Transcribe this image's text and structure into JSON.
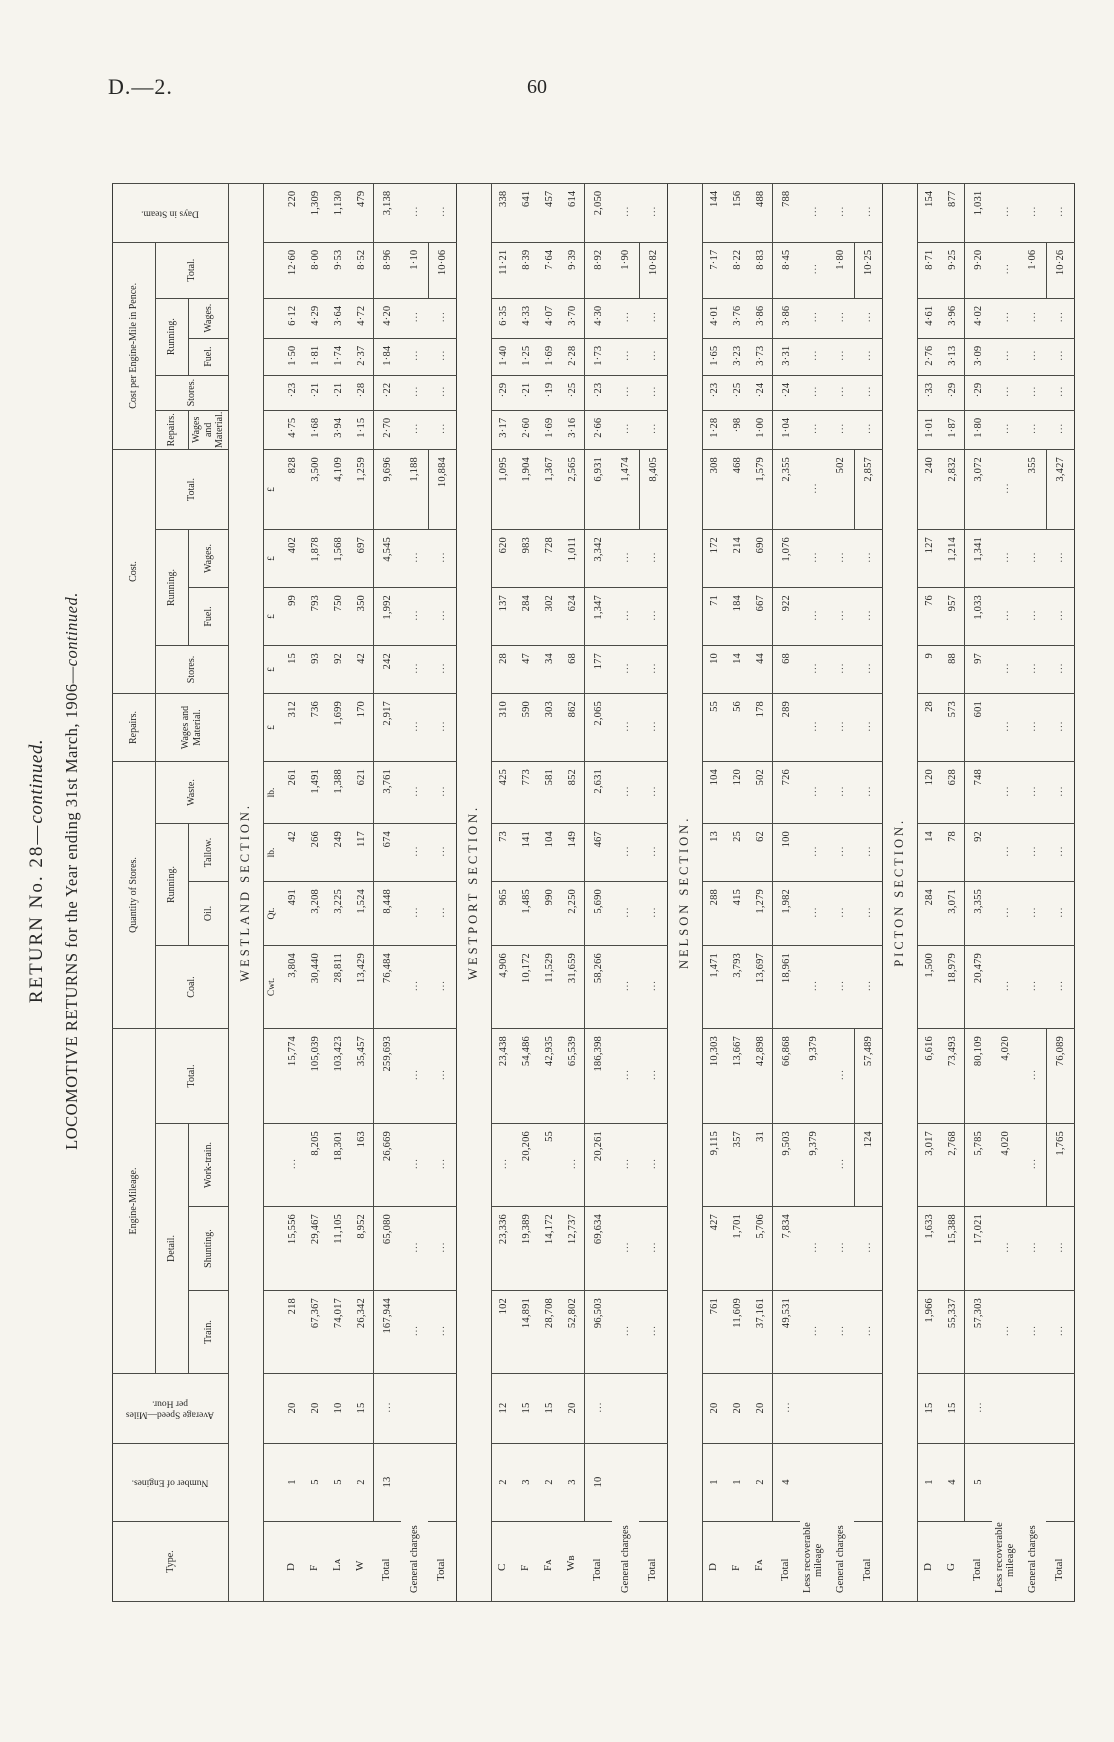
{
  "page": {
    "doc_ref": "D.—2.",
    "page_number": "60"
  },
  "title": {
    "line1": "RETURN No. 28—",
    "line1_cont": "continued.",
    "line2": "LOCOMOTIVE RETURNS for the Year ending 31st March, 1906—",
    "line2_cont": "continued."
  },
  "headers": {
    "type": "Type.",
    "number_of_engines": "Number of Engines.",
    "average_speed": "Average Speed—Miles per Hour.",
    "engine_mileage": "Engine-Mileage.",
    "detail": "Detail.",
    "train": "Train.",
    "shunting": "Shunting.",
    "work_train": "Work-train.",
    "total": "Total.",
    "quantity_of_stores": "Quantity of Stores.",
    "coal": "Coal.",
    "running": "Running.",
    "oil": "Oil.",
    "tallow": "Tallow.",
    "waste": "Waste.",
    "repairs": "Repairs.",
    "wages_and_material": "Wages and Material.",
    "cost": "Cost.",
    "stores": "Stores.",
    "fuel": "Fuel.",
    "wages": "Wages.",
    "cost_per_mile": "Cost per Engine-Mile in Pence.",
    "days_in_steam": "Days in Steam."
  },
  "units": [
    "",
    "",
    "",
    "",
    "",
    "",
    "Cwt.",
    "Qt.",
    "lb.",
    "lb.",
    "£",
    "£",
    "£",
    "£",
    "£",
    "",
    "",
    "",
    "",
    "",
    ""
  ],
  "sections": [
    {
      "name": "WESTLAND SECTION.",
      "show_units": true,
      "rows": [
        {
          "label": "D",
          "kind": "data",
          "cells": [
            "1",
            "20",
            "218",
            "15,556",
            "...",
            "15,774",
            "3,804",
            "491",
            "42",
            "261",
            "312",
            "15",
            "99",
            "402",
            "828",
            "4·75",
            "·23",
            "1·50",
            "6·12",
            "12·60",
            "220"
          ]
        },
        {
          "label": "F",
          "kind": "data",
          "cells": [
            "5",
            "20",
            "67,367",
            "29,467",
            "8,205",
            "105,039",
            "30,440",
            "3,208",
            "266",
            "1,491",
            "736",
            "93",
            "793",
            "1,878",
            "3,500",
            "1·68",
            "·21",
            "1·81",
            "4·29",
            "8·00",
            "1,309"
          ]
        },
        {
          "label": "Lᴀ",
          "kind": "data",
          "cells": [
            "5",
            "10",
            "74,017",
            "11,105",
            "18,301",
            "103,423",
            "28,811",
            "3,225",
            "249",
            "1,388",
            "1,699",
            "92",
            "750",
            "1,568",
            "4,109",
            "3·94",
            "·21",
            "1·74",
            "3·64",
            "9·53",
            "1,130"
          ]
        },
        {
          "label": "W",
          "kind": "data",
          "cells": [
            "2",
            "15",
            "26,342",
            "8,952",
            "163",
            "35,457",
            "13,429",
            "1,524",
            "117",
            "621",
            "170",
            "42",
            "350",
            "697",
            "1,259",
            "1·15",
            "·28",
            "2·37",
            "4·72",
            "8·52",
            "479"
          ]
        },
        {
          "label": "Total",
          "kind": "total",
          "cells": [
            "13",
            "...",
            "167,944",
            "65,080",
            "26,669",
            "259,693",
            "76,484",
            "8,448",
            "674",
            "3,761",
            "2,917",
            "242",
            "1,992",
            "4,545",
            "9,696",
            "2·70",
            "·22",
            "1·84",
            "4·20",
            "8·96",
            "3,138"
          ]
        },
        {
          "label": "General charges",
          "kind": "gen",
          "wide": true,
          "cells": [
            "",
            "",
            "...",
            "...",
            "...",
            "...",
            "...",
            "...",
            "...",
            "...",
            "...",
            "...",
            "...",
            "...",
            "1,188",
            "...",
            "...",
            "...",
            "...",
            "1·10",
            "..."
          ]
        },
        {
          "label": "Total",
          "kind": "final",
          "cells": [
            "",
            "",
            "...",
            "...",
            "...",
            "...",
            "...",
            "...",
            "...",
            "...",
            "...",
            "...",
            "...",
            "...",
            "10,884",
            "...",
            "...",
            "...",
            "...",
            "10·06",
            "..."
          ]
        }
      ]
    },
    {
      "name": "WESTPORT SECTION.",
      "show_units": false,
      "rows": [
        {
          "label": "C",
          "kind": "data",
          "cells": [
            "2",
            "12",
            "102",
            "23,336",
            "...",
            "23,438",
            "4,906",
            "965",
            "73",
            "425",
            "310",
            "28",
            "137",
            "620",
            "1,095",
            "3·17",
            "·29",
            "1·40",
            "6·35",
            "11·21",
            "338"
          ]
        },
        {
          "label": "F",
          "kind": "data",
          "cells": [
            "3",
            "15",
            "14,891",
            "19,389",
            "20,206",
            "54,486",
            "10,172",
            "1,485",
            "141",
            "773",
            "590",
            "47",
            "284",
            "983",
            "1,904",
            "2·60",
            "·21",
            "1·25",
            "4·33",
            "8·39",
            "641"
          ]
        },
        {
          "label": "Fᴀ",
          "kind": "data",
          "cells": [
            "2",
            "15",
            "28,708",
            "14,172",
            "55",
            "42,935",
            "11,529",
            "990",
            "104",
            "581",
            "303",
            "34",
            "302",
            "728",
            "1,367",
            "1·69",
            "·19",
            "1·69",
            "4·07",
            "7·64",
            "457"
          ]
        },
        {
          "label": "Wʙ",
          "kind": "data",
          "cells": [
            "3",
            "20",
            "52,802",
            "12,737",
            "...",
            "65,539",
            "31,659",
            "2,250",
            "149",
            "852",
            "862",
            "68",
            "624",
            "1,011",
            "2,565",
            "3·16",
            "·25",
            "2·28",
            "3·70",
            "9·39",
            "614"
          ]
        },
        {
          "label": "Total",
          "kind": "total",
          "cells": [
            "10",
            "...",
            "96,503",
            "69,634",
            "20,261",
            "186,398",
            "58,266",
            "5,690",
            "467",
            "2,631",
            "2,065",
            "177",
            "1,347",
            "3,342",
            "6,931",
            "2·66",
            "·23",
            "1·73",
            "4·30",
            "8·92",
            "2,050"
          ]
        },
        {
          "label": "General charges",
          "kind": "gen",
          "wide": true,
          "cells": [
            "",
            "",
            "...",
            "...",
            "...",
            "...",
            "...",
            "...",
            "...",
            "...",
            "...",
            "...",
            "...",
            "...",
            "1,474",
            "...",
            "...",
            "...",
            "...",
            "1·90",
            "..."
          ]
        },
        {
          "label": "Total",
          "kind": "final",
          "cells": [
            "",
            "",
            "...",
            "...",
            "...",
            "...",
            "...",
            "...",
            "...",
            "...",
            "...",
            "...",
            "...",
            "...",
            "8,405",
            "...",
            "...",
            "...",
            "...",
            "10·82",
            "..."
          ]
        }
      ]
    },
    {
      "name": "NELSON SECTION.",
      "show_units": false,
      "rows": [
        {
          "label": "D",
          "kind": "data",
          "cells": [
            "1",
            "20",
            "761",
            "427",
            "9,115",
            "10,303",
            "1,471",
            "288",
            "13",
            "104",
            "55",
            "10",
            "71",
            "172",
            "308",
            "1·28",
            "·23",
            "1·65",
            "4·01",
            "7·17",
            "144"
          ]
        },
        {
          "label": "F",
          "kind": "data",
          "cells": [
            "1",
            "20",
            "11,609",
            "1,701",
            "357",
            "13,667",
            "3,793",
            "415",
            "25",
            "120",
            "56",
            "14",
            "184",
            "214",
            "468",
            "·98",
            "·25",
            "3·23",
            "3·76",
            "8·22",
            "156"
          ]
        },
        {
          "label": "Fᴀ",
          "kind": "data",
          "cells": [
            "2",
            "20",
            "37,161",
            "5,706",
            "31",
            "42,898",
            "13,697",
            "1,279",
            "62",
            "502",
            "178",
            "44",
            "667",
            "690",
            "1,579",
            "1·00",
            "·24",
            "3·73",
            "3·86",
            "8·83",
            "488"
          ]
        },
        {
          "label": "Total",
          "kind": "total",
          "cells": [
            "4",
            "...",
            "49,531",
            "7,834",
            "9,503",
            "66,868",
            "18,961",
            "1,982",
            "100",
            "726",
            "289",
            "68",
            "922",
            "1,076",
            "2,355",
            "1·04",
            "·24",
            "3·31",
            "3·86",
            "8·45",
            "788"
          ]
        },
        {
          "label": "Less recoverable\nmileage",
          "kind": "less",
          "wide": true,
          "cells": [
            "",
            "",
            "...",
            "...",
            "9,379",
            "9,379",
            "...",
            "...",
            "...",
            "...",
            "...",
            "...",
            "...",
            "...",
            "...",
            "...",
            "...",
            "...",
            "...",
            "...",
            "..."
          ]
        },
        {
          "label": "General charges",
          "kind": "gen",
          "wide": true,
          "cells": [
            "",
            "",
            "...",
            "...",
            "...",
            "...",
            "...",
            "...",
            "...",
            "...",
            "...",
            "...",
            "...",
            "...",
            "502",
            "...",
            "...",
            "...",
            "...",
            "1·80",
            "..."
          ]
        },
        {
          "label": "Total",
          "kind": "final",
          "cells": [
            "",
            "",
            "...",
            "...",
            "124",
            "57,489",
            "...",
            "...",
            "...",
            "...",
            "...",
            "...",
            "...",
            "...",
            "2,857",
            "...",
            "...",
            "...",
            "...",
            "10·25",
            "..."
          ]
        }
      ]
    },
    {
      "name": "PICTON SECTION.",
      "show_units": false,
      "rows": [
        {
          "label": "D",
          "kind": "data",
          "cells": [
            "1",
            "15",
            "1,966",
            "1,633",
            "3,017",
            "6,616",
            "1,500",
            "284",
            "14",
            "120",
            "28",
            "9",
            "76",
            "127",
            "240",
            "1·01",
            "·33",
            "2·76",
            "4·61",
            "8·71",
            "154"
          ]
        },
        {
          "label": "G",
          "kind": "data",
          "cells": [
            "4",
            "15",
            "55,337",
            "15,388",
            "2,768",
            "73,493",
            "18,979",
            "3,071",
            "78",
            "628",
            "573",
            "88",
            "957",
            "1,214",
            "2,832",
            "1·87",
            "·29",
            "3·13",
            "3·96",
            "9·25",
            "877"
          ]
        },
        {
          "label": "Total",
          "kind": "total",
          "cells": [
            "5",
            "...",
            "57,303",
            "17,021",
            "5,785",
            "80,109",
            "20,479",
            "3,355",
            "92",
            "748",
            "601",
            "97",
            "1,033",
            "1,341",
            "3,072",
            "1·80",
            "·29",
            "3·09",
            "4·02",
            "9·20",
            "1,031"
          ]
        },
        {
          "label": "Less recoverable\nmileage",
          "kind": "less",
          "wide": true,
          "cells": [
            "",
            "",
            "...",
            "...",
            "4,020",
            "4,020",
            "...",
            "...",
            "...",
            "...",
            "...",
            "...",
            "...",
            "...",
            "...",
            "...",
            "...",
            "...",
            "...",
            "...",
            "..."
          ]
        },
        {
          "label": "General charges",
          "kind": "gen",
          "wide": true,
          "cells": [
            "",
            "",
            "...",
            "...",
            "...",
            "...",
            "...",
            "...",
            "...",
            "...",
            "...",
            "...",
            "...",
            "...",
            "355",
            "...",
            "...",
            "...",
            "...",
            "1·06",
            "..."
          ]
        },
        {
          "label": "Total",
          "kind": "final",
          "cells": [
            "",
            "",
            "...",
            "...",
            "1,765",
            "76,089",
            "...",
            "...",
            "...",
            "...",
            "...",
            "...",
            "...",
            "...",
            "3,427",
            "...",
            "...",
            "...",
            "...",
            "10·26",
            "..."
          ]
        }
      ]
    }
  ]
}
